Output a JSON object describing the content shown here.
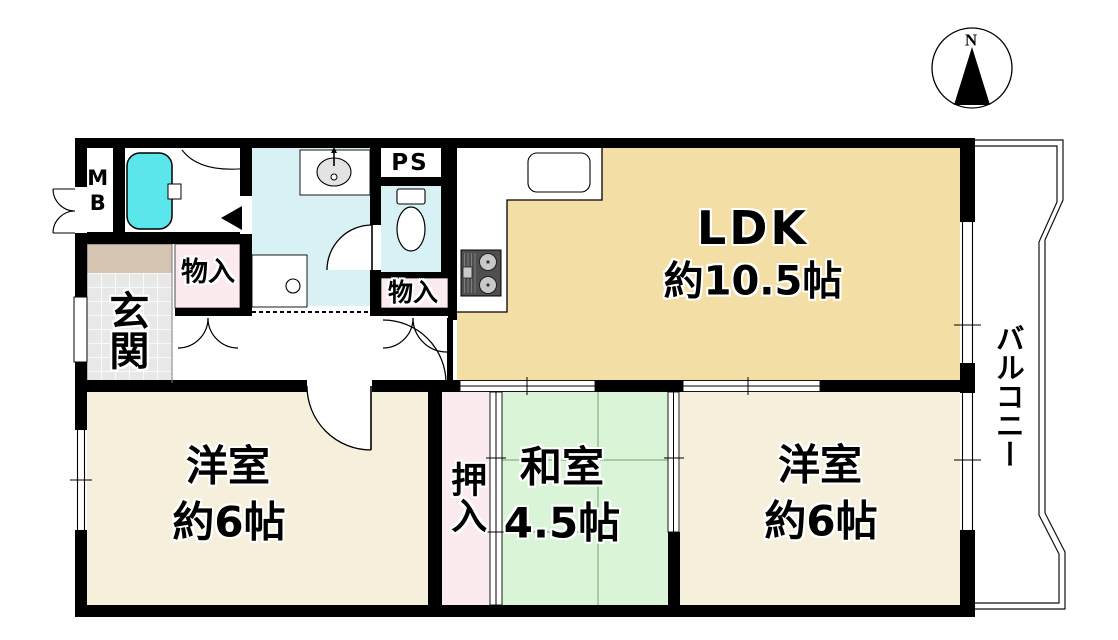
{
  "compass": {
    "north_label": "N"
  },
  "rooms": {
    "ldk": {
      "label": "LDK",
      "size": "約10.5帖"
    },
    "western_room_left": {
      "label": "洋室",
      "size": "約6帖"
    },
    "western_room_right": {
      "label": "洋室",
      "size": "約6帖"
    },
    "japanese_room": {
      "label": "和室",
      "size": "4.5帖"
    },
    "balcony": {
      "label": "バルコニー"
    },
    "entrance": {
      "label": "玄関"
    },
    "closet": {
      "label": "押入"
    },
    "storage_hall": {
      "label": "物入"
    },
    "storage_toilet": {
      "label": "物入"
    },
    "meter_box": {
      "label": "MB"
    },
    "pipe_space": {
      "label": "PS"
    }
  },
  "colors": {
    "wall": "#000000",
    "ldk_fill": "#F3DEA6",
    "western_room_fill": "#F6EFDC",
    "japanese_room_fill": "#D9F4D7",
    "closet_fill": "#FBEBEE",
    "wet_area_fill": "#D8F1F4",
    "bathtub_fill": "#5BE6EC",
    "entrance_tile_fill": "#E8E8E8",
    "entrance_step_fill": "#D3C5B2"
  }
}
